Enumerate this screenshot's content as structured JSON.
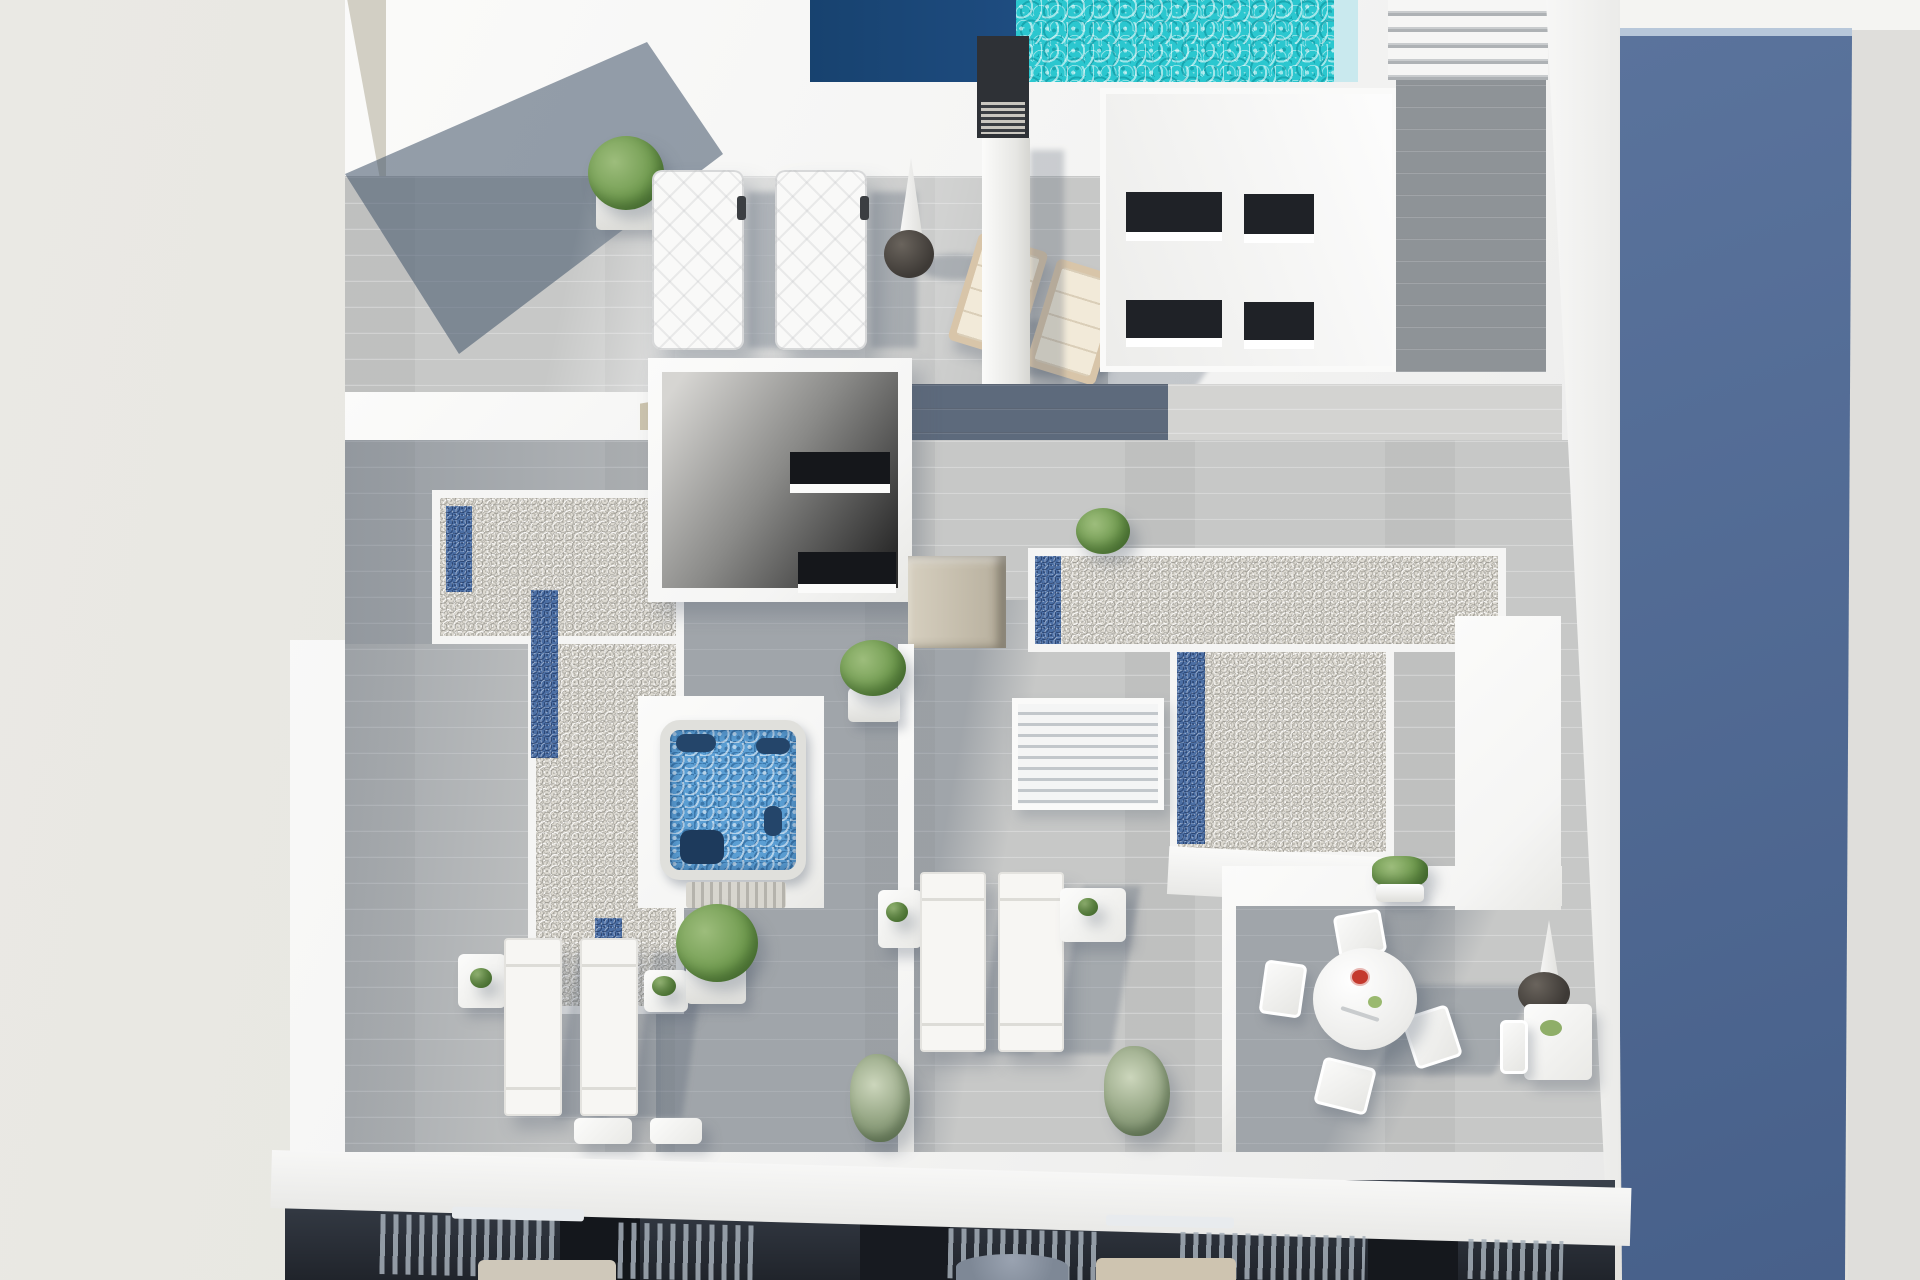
{
  "meta": {
    "title": "Aerial 3D architectural rendering of a penthouse rooftop solarium terrace",
    "visible_text": "none"
  },
  "palette": {
    "bg-left": "#e9e8e3",
    "beige-right": "#dfdedb",
    "building-white": "#f5f5f4",
    "wood-light": "#c7c8c7",
    "wood-lighter": "#d3d3d1",
    "wood-dark": "#5d6a7c",
    "wood-right": "#8e9397",
    "gravel-base": "#dcd9d1",
    "skylight-blue": "#4c6fa4",
    "facade-blue-1": "#5a739c",
    "facade-blue-2": "#47608a",
    "pool-deep-1": "#17426f",
    "pool-deep-2": "#1e4c80",
    "pool-turquoise": "#2bc7cf",
    "pool-edge": "#c9e9ee",
    "water-hottub": "#5b9ed3",
    "chimney-dark": "#2e3136",
    "tan-wall": "#cbc3ae",
    "lower-floor-1": "#3a414c",
    "lower-floor-2": "#20242b",
    "plant-green-1": "#9dbd7c",
    "plant-green-2": "#6f9a4e",
    "bush-olive": "#93a482",
    "cushion-cream": "#f2ead9",
    "wood-chair": "#d8c5a9",
    "red-flower": "#c43a2e"
  },
  "scene": {
    "type": "architectural-visualization",
    "view": "top-down aerial",
    "areas": [
      "swimming-pool-deck",
      "upper-sun-deck",
      "skylight-gravel-roofs",
      "hot-tub-patio",
      "stairwell-roofs",
      "left-sun-terrace",
      "center-sun-terrace",
      "dining-terrace",
      "lower-floor-balconies",
      "neighbouring-glass-facade"
    ],
    "objects": {
      "swimming-pool": {
        "deep_section_color": "navy",
        "shallow_section_color": "turquoise"
      },
      "hot-tub": {
        "water": "bubbling blue",
        "seats": 4
      },
      "white-sun-loungers": 9,
      "dark-sun-lounger": 1,
      "wooden-deck-chairs": 2,
      "closed-parasols": 2,
      "dining-set": {
        "table": "round white",
        "chairs": 4,
        "decor": "red flowers"
      },
      "side-tables": 7,
      "potted-plants": 9,
      "skylight-glass-strips": 5,
      "outdoor-shower-chimney": 1,
      "rooftop-staircase": 1,
      "louvered-pergola-roof": 1
    }
  }
}
